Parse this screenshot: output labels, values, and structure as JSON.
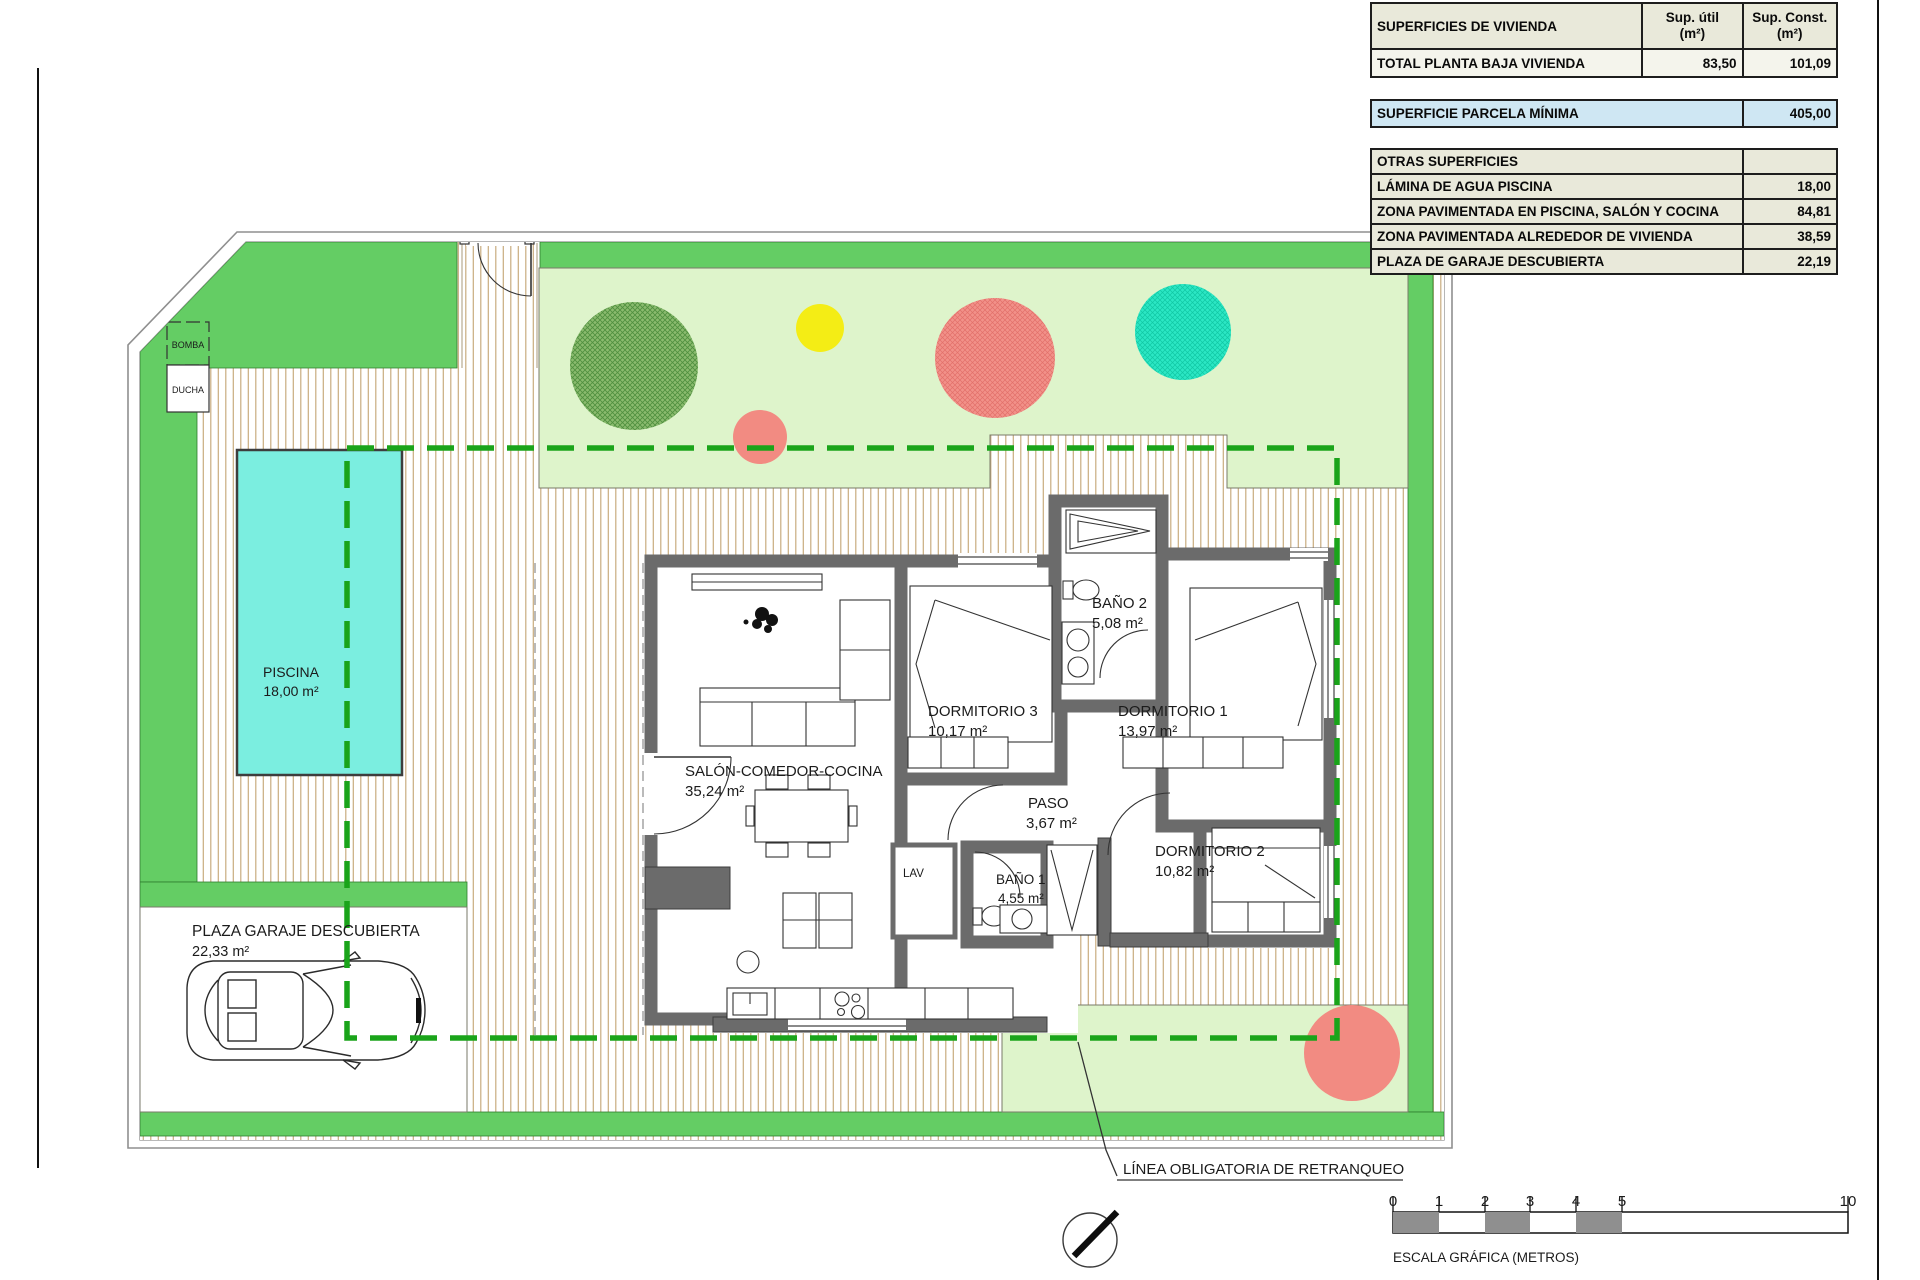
{
  "summary_table": {
    "header": {
      "c1": "SUPERFICIES DE VIVIENDA",
      "c2": "Sup. útil\n(m²)",
      "c3": "Sup. Const.\n(m²)"
    },
    "total_row": {
      "label": "TOTAL PLANTA BAJA VIVIENDA",
      "util": "83,50",
      "const": "101,09"
    },
    "parcela_row": {
      "label": "SUPERFICIE PARCELA MÍNIMA",
      "value": "405,00"
    },
    "otras_header": "OTRAS SUPERFICIES",
    "otras_rows": [
      {
        "label": "LÁMINA DE AGUA PISCINA",
        "value": "18,00"
      },
      {
        "label": "ZONA PAVIMENTADA EN PISCINA, SALÓN Y COCINA",
        "value": "84,81"
      },
      {
        "label": "ZONA PAVIMENTADA ALREDEDOR DE VIVIENDA",
        "value": "38,59"
      },
      {
        "label": "PLAZA DE GARAJE DESCUBIERTA",
        "value": "22,19"
      }
    ]
  },
  "plan": {
    "rooms": {
      "salon": {
        "name": "SALÓN-COMEDOR-COCINA",
        "area": "35,24 m²"
      },
      "dormitorio1": {
        "name": "DORMITORIO 1",
        "area": "13,97 m²"
      },
      "dormitorio2": {
        "name": "DORMITORIO 2",
        "area": "10,82 m²"
      },
      "dormitorio3": {
        "name": "DORMITORIO 3",
        "area": "10,17 m²"
      },
      "banio1": {
        "name": "BAÑO 1",
        "area": "4,55 m²"
      },
      "banio2": {
        "name": "BAÑO 2",
        "area": "5,08 m²"
      },
      "paso": {
        "name": "PASO",
        "area": "3,67 m²"
      },
      "lav": {
        "name": "LAV"
      }
    },
    "outdoor": {
      "piscina": {
        "name": "PISCINA",
        "area": "18,00 m²"
      },
      "plaza_garaje": {
        "name": "PLAZA GARAJE DESCUBIERTA",
        "area": "22,33 m²"
      },
      "bomba": {
        "name": "BOMBA"
      },
      "ducha": {
        "name": "DUCHA"
      }
    },
    "annotations": {
      "retranqueo": "LÍNEA OBLIGATORIA DE RETRANQUEO"
    }
  },
  "scale_bar": {
    "ticks": [
      "0",
      "1",
      "2",
      "3",
      "4",
      "5",
      "10"
    ],
    "caption": "ESCALA GRÁFICA (METROS)"
  },
  "colors": {
    "lawn_green": "#64cd64",
    "garden_green": "#def4cb",
    "pool_cyan": "#7beee0",
    "wall_gray": "#6b6b6b",
    "retranqueo_green": "#1aa41a",
    "parcela_row_blue": "#cfe7f3",
    "table_beige": "#e9e9da",
    "tree_coral": "#f28b82",
    "tree_teal": "#2be7c4",
    "tree_yellow": "#f4ed15",
    "tree_green": "#8abb6e",
    "paving_stripe": "#c8ab7e"
  }
}
